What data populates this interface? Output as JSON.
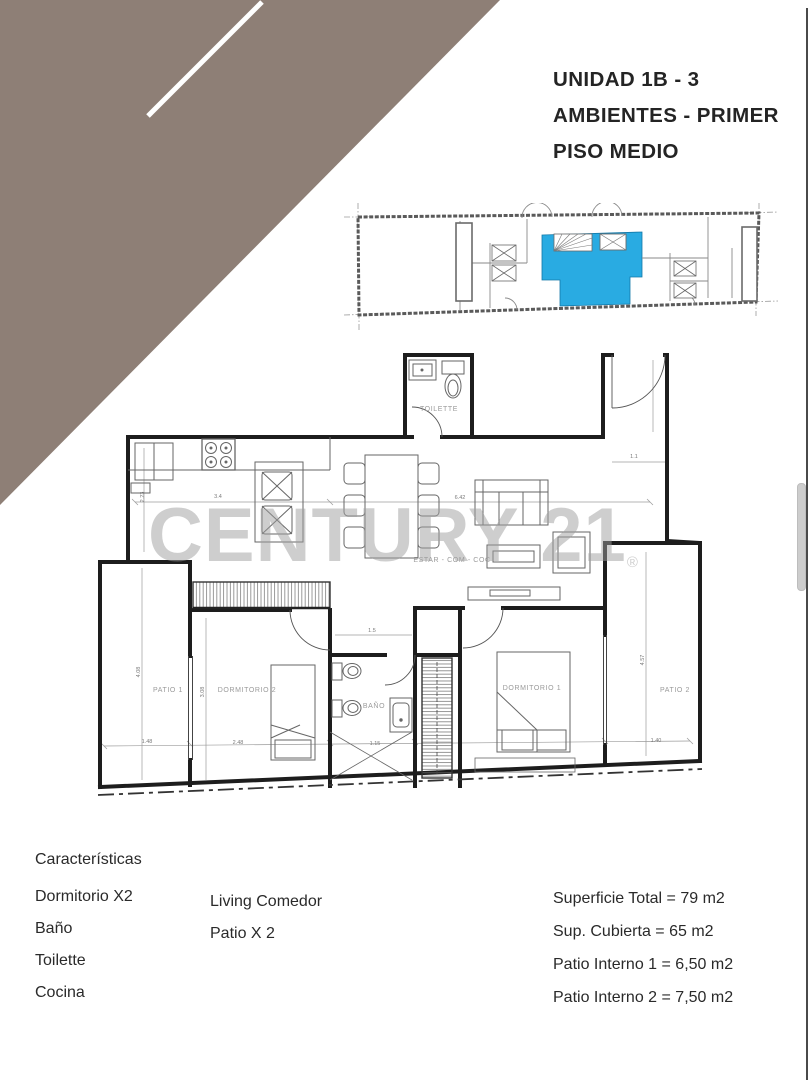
{
  "title": {
    "lines": [
      "UNIDAD 1B - 3",
      "AMBIENTES - PRIMER",
      "PISO MEDIO"
    ]
  },
  "deco": {
    "triangle_color": "#8E7F76",
    "stripe_color": "#ffffff"
  },
  "mini_plan": {
    "highlight_color": "#29ABE2"
  },
  "plan": {
    "room_labels": {
      "toilette": "TOILETTE",
      "living": "ESTAR - COM - COC",
      "patio1": "PATIO 1",
      "dorm2": "DORMITORIO 2",
      "bath": "BAÑO",
      "dorm1": "DORMITORIO 1",
      "patio2": "PATIO 2"
    },
    "dimensions": [
      "2.23",
      "3.4",
      "6.42",
      "1.1",
      "4.08",
      "3.08",
      "1.48",
      "2.48",
      "1.15",
      "1.5",
      "4.57",
      "1.40"
    ]
  },
  "watermark": {
    "text": "CENTURY 21",
    "registered": "®"
  },
  "footer": {
    "heading": "Características",
    "features_col1": [
      "Dormitorio X2",
      "Baño",
      "Toilette",
      "Cocina"
    ],
    "features_col2": [
      "Living Comedor",
      "Patio X 2"
    ],
    "areas": [
      "Superficie Total = 79 m2",
      "Sup. Cubierta = 65  m2",
      "Patio Interno 1 = 6,50 m2",
      "Patio Interno 2 = 7,50 m2"
    ]
  }
}
